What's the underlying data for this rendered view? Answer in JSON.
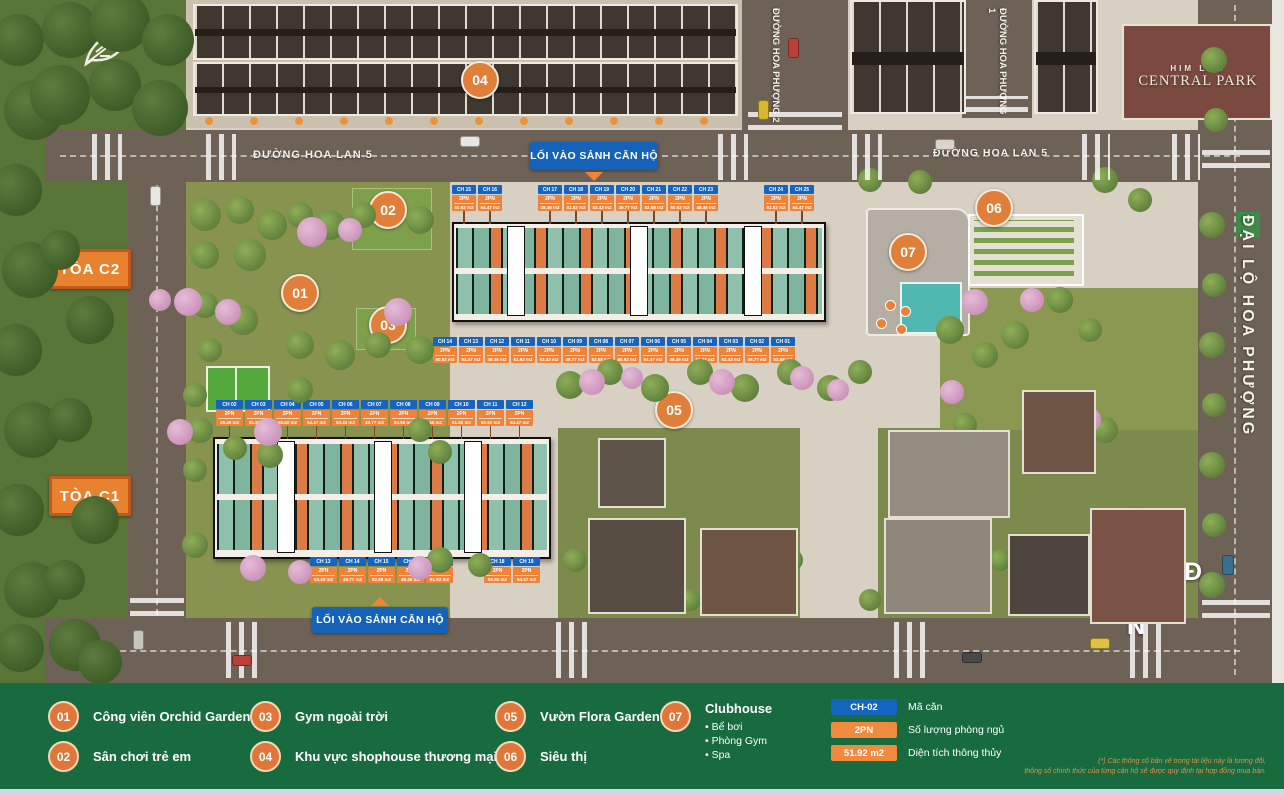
{
  "brand": {
    "line1": "HIM LAM",
    "line2": "CENTRAL PARK"
  },
  "roads": {
    "hoa_lan_5": "ĐƯỜNG HOA LAN 5",
    "hoa_phuong_2": "ĐƯỜNG HOA PHƯỢNG 2",
    "hoa_phuong_1": "ĐƯỜNG HOA PHƯỢNG 1",
    "dai_lo": "ĐẠI LỘ HOA PHƯỢNG"
  },
  "entrance_label": "LỐI VÀO SẢNH CĂN HỘ",
  "towers": {
    "c2": "TÒA C2",
    "c1": "TÒA C1"
  },
  "markers": [
    "01",
    "02",
    "03",
    "04",
    "05",
    "06",
    "07"
  ],
  "compass": {
    "n": "B",
    "e": "Đ",
    "s": "N",
    "w": "T"
  },
  "colors": {
    "accent_orange": "#ef8438",
    "badge_blue": "#1565c0",
    "legend_green": "#176b3f"
  },
  "units": {
    "c2_top_a": [
      {
        "code": "CH 15",
        "bed": "2PN",
        "area": "50.92 m2"
      },
      {
        "code": "CH 16",
        "bed": "2PN",
        "area": "54.47 m2"
      }
    ],
    "c2_top_b": [
      {
        "code": "CH 17",
        "bed": "2PN",
        "area": "48.46 m2"
      },
      {
        "code": "CH 18",
        "bed": "2PN",
        "area": "51.92 m2"
      },
      {
        "code": "CH 19",
        "bed": "2PN",
        "area": "53.43 m2"
      },
      {
        "code": "CH 20",
        "bed": "2PN",
        "area": "49.77 m2"
      },
      {
        "code": "CH 21",
        "bed": "2PN",
        "area": "52.68 m2"
      },
      {
        "code": "CH 22",
        "bed": "2PN",
        "area": "50.92 m2"
      },
      {
        "code": "CH 23",
        "bed": "2PN",
        "area": "48.46 m2"
      }
    ],
    "c2_top_c": [
      {
        "code": "CH 24",
        "bed": "2PN",
        "area": "51.92 m2"
      },
      {
        "code": "CH 25",
        "bed": "2PN",
        "area": "54.47 m2"
      }
    ],
    "c2_bottom": [
      {
        "code": "CH 14",
        "bed": "2PN",
        "area": "50.92 m2"
      },
      {
        "code": "CH 13",
        "bed": "2PN",
        "area": "54.47 m2"
      },
      {
        "code": "CH 12",
        "bed": "2PN",
        "area": "48.46 m2"
      },
      {
        "code": "CH 11",
        "bed": "2PN",
        "area": "51.92 m2"
      },
      {
        "code": "CH 10",
        "bed": "2PN",
        "area": "53.43 m2"
      },
      {
        "code": "CH 09",
        "bed": "2PN",
        "area": "49.77 m2"
      },
      {
        "code": "CH 08",
        "bed": "2PN",
        "area": "52.68 m2"
      },
      {
        "code": "CH 07",
        "bed": "2PN",
        "area": "50.92 m2"
      },
      {
        "code": "CH 06",
        "bed": "2PN",
        "area": "54.47 m2"
      },
      {
        "code": "CH 05",
        "bed": "2PN",
        "area": "48.46 m2"
      },
      {
        "code": "CH 04",
        "bed": "2PN",
        "area": "51.92 m2"
      },
      {
        "code": "CH 03",
        "bed": "2PN",
        "area": "53.43 m2"
      },
      {
        "code": "CH 02",
        "bed": "2PN",
        "area": "49.77 m2"
      },
      {
        "code": "CH 01",
        "bed": "2PN",
        "area": "52.68 m2"
      }
    ],
    "c1_top": [
      {
        "code": "CH 02",
        "bed": "2PN",
        "area": "48.46 m2"
      },
      {
        "code": "CH 03",
        "bed": "2PN",
        "area": "51.92 m2"
      },
      {
        "code": "CH 04",
        "bed": "2PN",
        "area": "50.92 m2"
      },
      {
        "code": "CH 05",
        "bed": "2PN",
        "area": "54.47 m2"
      },
      {
        "code": "CH 06",
        "bed": "2PN",
        "area": "53.43 m2"
      },
      {
        "code": "CH 07",
        "bed": "2PN",
        "area": "49.77 m2"
      },
      {
        "code": "CH 08",
        "bed": "2PN",
        "area": "52.68 m2"
      },
      {
        "code": "CH 09",
        "bed": "2PN",
        "area": "48.46 m2"
      },
      {
        "code": "CH 10",
        "bed": "2PN",
        "area": "51.92 m2"
      },
      {
        "code": "CH 11",
        "bed": "2PN",
        "area": "50.92 m2"
      },
      {
        "code": "CH 12",
        "bed": "2PN",
        "area": "54.47 m2"
      }
    ],
    "c1_bottom_a": [
      {
        "code": "CH 13",
        "bed": "2PN",
        "area": "53.43 m2"
      },
      {
        "code": "CH 14",
        "bed": "2PN",
        "area": "49.77 m2"
      },
      {
        "code": "CH 15",
        "bed": "2PN",
        "area": "52.68 m2"
      },
      {
        "code": "CH 16",
        "bed": "2PN",
        "area": "48.46 m2"
      },
      {
        "code": "CH 17",
        "bed": "2PN",
        "area": "51.92 m2"
      }
    ],
    "c1_bottom_b": [
      {
        "code": "CH 18",
        "bed": "2PN",
        "area": "50.92 m2"
      },
      {
        "code": "CH 19",
        "bed": "2PN",
        "area": "54.47 m2"
      }
    ]
  },
  "legend": {
    "items": [
      {
        "num": "01",
        "label": "Công viên Orchid Garden"
      },
      {
        "num": "02",
        "label": "Sân chơi trẻ em"
      },
      {
        "num": "03",
        "label": "Gym ngoài trời"
      },
      {
        "num": "04",
        "label": "Khu vực shophouse thương mại"
      },
      {
        "num": "05",
        "label": "Vườn Flora Garden"
      },
      {
        "num": "06",
        "label": "Siêu thị"
      },
      {
        "num": "07",
        "label": "Clubhouse"
      }
    ],
    "clubhouse_bullets": [
      "• Bể bơi",
      "• Phòng Gym",
      "• Spa"
    ],
    "key": [
      {
        "value": "CH-02",
        "label": "Mã căn"
      },
      {
        "value": "2PN",
        "label": "Số lượng phòng ngủ"
      },
      {
        "value": "51.92 m2",
        "label": "Diện tích thông thủy"
      }
    ],
    "disclaimer_line1": "(*) Các thông số bản vẽ trong tài liệu này là tương đối,",
    "disclaimer_line2": "thông số chính thức của từng căn hộ sẽ được quy định tại hợp đồng mua bán."
  }
}
